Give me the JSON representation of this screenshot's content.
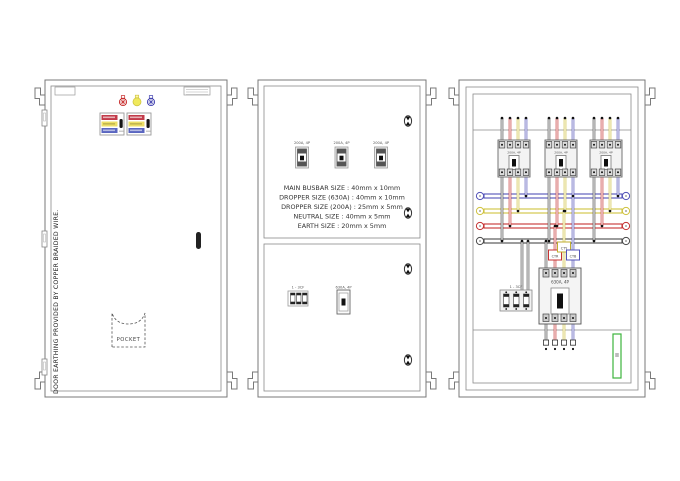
{
  "door_view": {
    "note": "DOOR EARTHING PROVIDED BY COPPER BRAIDED WIRE.",
    "pocket_label": "POCKET",
    "lamp_colors": [
      "#c62828",
      "#f0e95c",
      "#3f3fae"
    ]
  },
  "inner_door_view": {
    "feeder_switch_label": "200A, 4P",
    "specs": [
      "MAIN BUSBAR SIZE : 40mm x 10mm",
      "DROPPER SIZE (630A) : 40mm x 10mm",
      "DROPPER SIZE (200A) : 25mm x 5mm",
      "NEUTRAL SIZE : 40mm x 5mm",
      "EARTH SIZE : 20mm x 5mm"
    ],
    "fuse_label": "1 - 3CF",
    "incomer_label": "630A, 4P"
  },
  "equipment_view": {
    "feeder_mccb_label": "200A, 4P",
    "ct_labels": [
      "CTR",
      "CTY",
      "CTB"
    ],
    "incomer_label": "630A, 4P",
    "fuse_label": "1 - 3CF"
  },
  "colors": {
    "phase_r": "#c63333",
    "phase_y": "#cfc23e",
    "phase_b": "#5252b8",
    "neutral": "#4a4a4a",
    "earth_green": "#3db43d",
    "line": "#787878"
  }
}
